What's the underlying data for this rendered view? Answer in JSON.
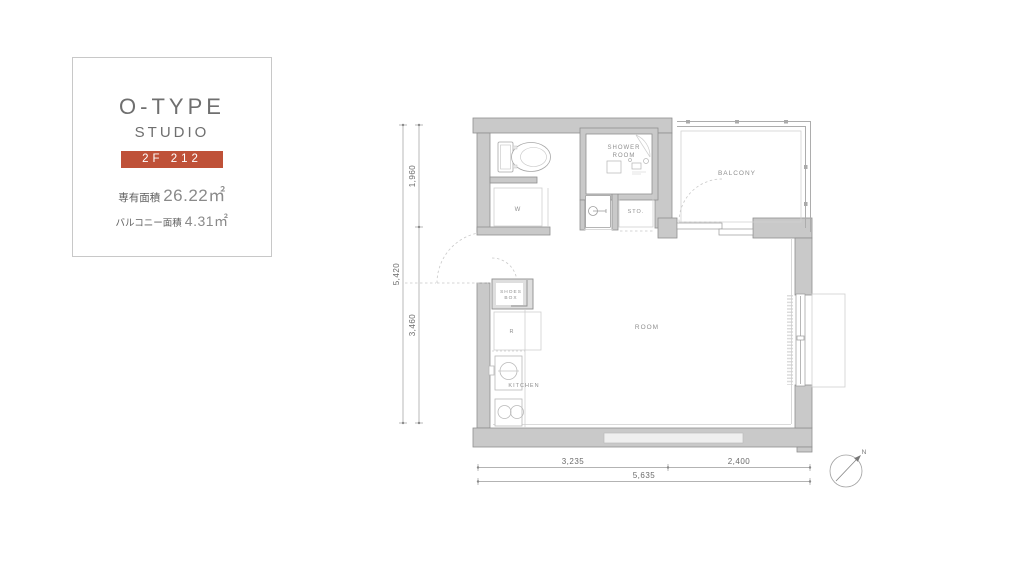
{
  "info_card": {
    "type_name": "O-TYPE",
    "type_sub": "STUDIO",
    "unit_badge": "2F 212",
    "area_label": "専有面積",
    "area_value": "26.22㎡",
    "balcony_area_label": "バルコニー面積",
    "balcony_area_value": "4.31㎡"
  },
  "plan": {
    "labels": {
      "shower_room_line1": "SHOWER",
      "shower_room_line2": "ROOM",
      "storage": "STO.",
      "balcony": "BALCONY",
      "room": "ROOM",
      "kitchen": "KITCHEN",
      "shoes_box_line1": "SHOES",
      "shoes_box_line2": "BOX",
      "washer": "W",
      "refrigerator": "R"
    },
    "dimensions": {
      "left_total": "5,420",
      "left_upper": "1,960",
      "left_lower": "3,460",
      "bottom_left": "3,235",
      "bottom_right": "2,400",
      "bottom_total": "5,635"
    },
    "compass_north": "N",
    "colors": {
      "badge": "#bf5138",
      "wall_fill": "#c9c9c9",
      "wall_stroke": "#8f8f8f"
    }
  }
}
